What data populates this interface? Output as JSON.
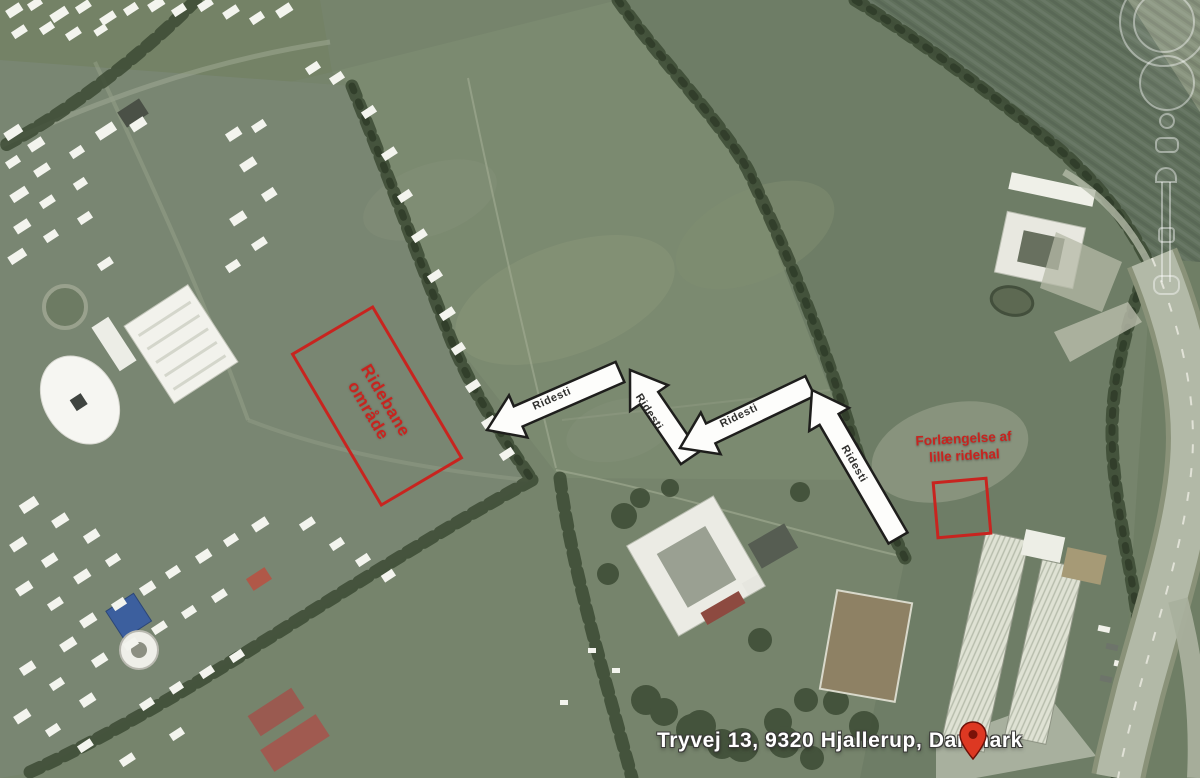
{
  "annotations": {
    "accent_color": "#c8241f",
    "riding_area": {
      "line1": "Ridebane",
      "line2": "område"
    },
    "extension": {
      "line1": "Forlængelse af",
      "line2": "lille ridehal"
    },
    "arrows": [
      {
        "label": "Ridesti"
      },
      {
        "label": "Ridesti"
      },
      {
        "label": "Ridesti"
      },
      {
        "label": "Ridesti"
      }
    ],
    "arrow_fill": "#fdfdfb",
    "arrow_outline": "#1e1e1c"
  },
  "placemark": {
    "address": "Tryvej 13, 9320 Hjallerup, Danmark",
    "pin_color": "#dd3822",
    "label_color": "#ffffff"
  },
  "controls": {
    "look_ring_icon": "look-ring",
    "pan_joystick_icon": "pan-joystick",
    "zoom_slider_icon": "zoom-slider"
  }
}
